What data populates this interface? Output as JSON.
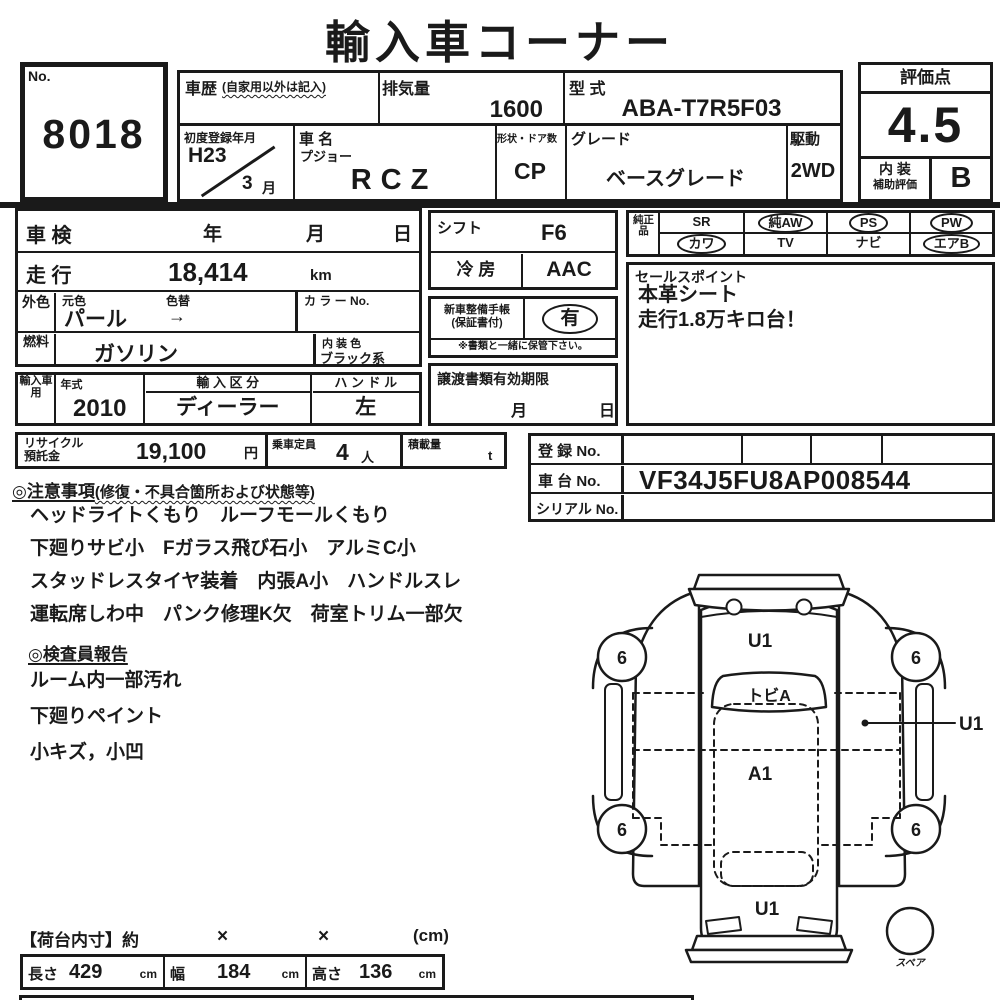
{
  "title": "輸入車コーナー",
  "no_box": {
    "label": "No.",
    "value": "8018"
  },
  "top_table": {
    "history_label": "車歴",
    "history_note": "(自家用以外は記入)",
    "displacement_label": "排気量",
    "displacement_value": "1600",
    "model_label": "型 式",
    "model_value": "ABA-T7R5F03",
    "first_reg_label": "初度登録年月",
    "first_reg_year": "H23",
    "first_reg_month": "3",
    "first_reg_month_unit": "月",
    "name_label": "車 名",
    "brand": "プジョー",
    "model_name": "RCZ",
    "body_label": "形状・ドア数",
    "body_value": "CP",
    "grade_label": "グレード",
    "grade_value": "ベースグレード",
    "drive_label": "駆動",
    "drive_value": "2WD"
  },
  "rating": {
    "label": "評価点",
    "score": "4.5",
    "interior_line1": "内 装",
    "interior_line2": "補助評価",
    "interior_grade": "B"
  },
  "inspection_row": {
    "label": "車 検",
    "year": "年",
    "month": "月",
    "day": "日"
  },
  "mileage_row": {
    "label": "走 行",
    "value": "18,414",
    "unit": "km"
  },
  "exterior_row": {
    "label": "外色",
    "original_label": "元色",
    "change_label": "色替",
    "value": "パール",
    "arrow": "→",
    "color_no_label": "カ ラ ー No."
  },
  "fuel_row": {
    "label": "燃料",
    "value": "ガソリン",
    "interior_label": "内 装 色",
    "interior_value": "ブラック系"
  },
  "import_row": {
    "label": "輸入車用",
    "year_label": "年式",
    "year_value": "2010",
    "division_label": "輸 入 区 分",
    "division_value": "ディーラー",
    "handle_label": "ハ ン ド ル",
    "handle_value": "左"
  },
  "recycle_row": {
    "label_line1": "リサイクル",
    "label_line2": "預託金",
    "value": "19,100",
    "unit": "円",
    "seats_label": "乗車定員",
    "seats_value": "4",
    "seats_unit": "人",
    "load_label": "積載量",
    "load_unit": "t"
  },
  "shift_box": {
    "shift_label": "シフト",
    "shift_value": "F6",
    "ac_label": "冷 房",
    "ac_value": "AAC"
  },
  "service_book": {
    "line1": "新車整備手帳",
    "line2": "(保証書付)",
    "value": "有",
    "note": "※書類と一緒に保管下さい。"
  },
  "transfer_box": {
    "label": "譲渡書類有効期限",
    "month": "月",
    "day": "日"
  },
  "genuine": {
    "label": "純正品",
    "items": [
      {
        "label": "SR",
        "circled": false
      },
      {
        "label": "純AW",
        "circled": true
      },
      {
        "label": "PS",
        "circled": true
      },
      {
        "label": "PW",
        "circled": true
      },
      {
        "label": "カワ",
        "circled": true
      },
      {
        "label": "TV",
        "circled": false
      },
      {
        "label": "ナビ",
        "circled": false
      },
      {
        "label": "エアB",
        "circled": true
      }
    ]
  },
  "sales": {
    "label": "セールスポイント",
    "lines": [
      "本革シート",
      "走行1.8万キロ台！"
    ]
  },
  "registration": {
    "reg_label": "登 録 No.",
    "chassis_label": "車 台 No.",
    "chassis_value": "VF34J5FU8AP008544",
    "serial_label": "シリアル No."
  },
  "cautions": {
    "header": "◎注意事項",
    "note": "(修復・不具合箇所および状態等)",
    "lines": [
      "ヘッドライトくもり　ルーフモールくもり",
      "下廻りサビ小　Fガラス飛び石小　アルミC小",
      "スタッドレスタイヤ装着　内張A小　ハンドルスレ",
      "運転席しわ中　パンク修理K欠　荷室トリム一部欠"
    ]
  },
  "inspector": {
    "header": "◎検査員報告",
    "lines": [
      "ルーム内一部汚れ",
      "下廻りペイント",
      "小キズ，小凹"
    ]
  },
  "diagram": {
    "hood_label": "U1",
    "windshield_label": "トビA",
    "cabin_label": "A1",
    "rear_label": "U1",
    "side_label": "U1",
    "wheel_labels": [
      "6",
      "6",
      "6",
      "6"
    ],
    "spare_label": "スペア"
  },
  "cargo": {
    "header": "【荷台内寸】約",
    "times1": "×",
    "times2": "×",
    "unit": "(cm)",
    "length_label": "長さ",
    "length_value": "429",
    "length_unit": "cm",
    "width_label": "幅",
    "width_value": "184",
    "width_unit": "cm",
    "height_label": "高さ",
    "height_value": "136",
    "height_unit": "cm"
  }
}
